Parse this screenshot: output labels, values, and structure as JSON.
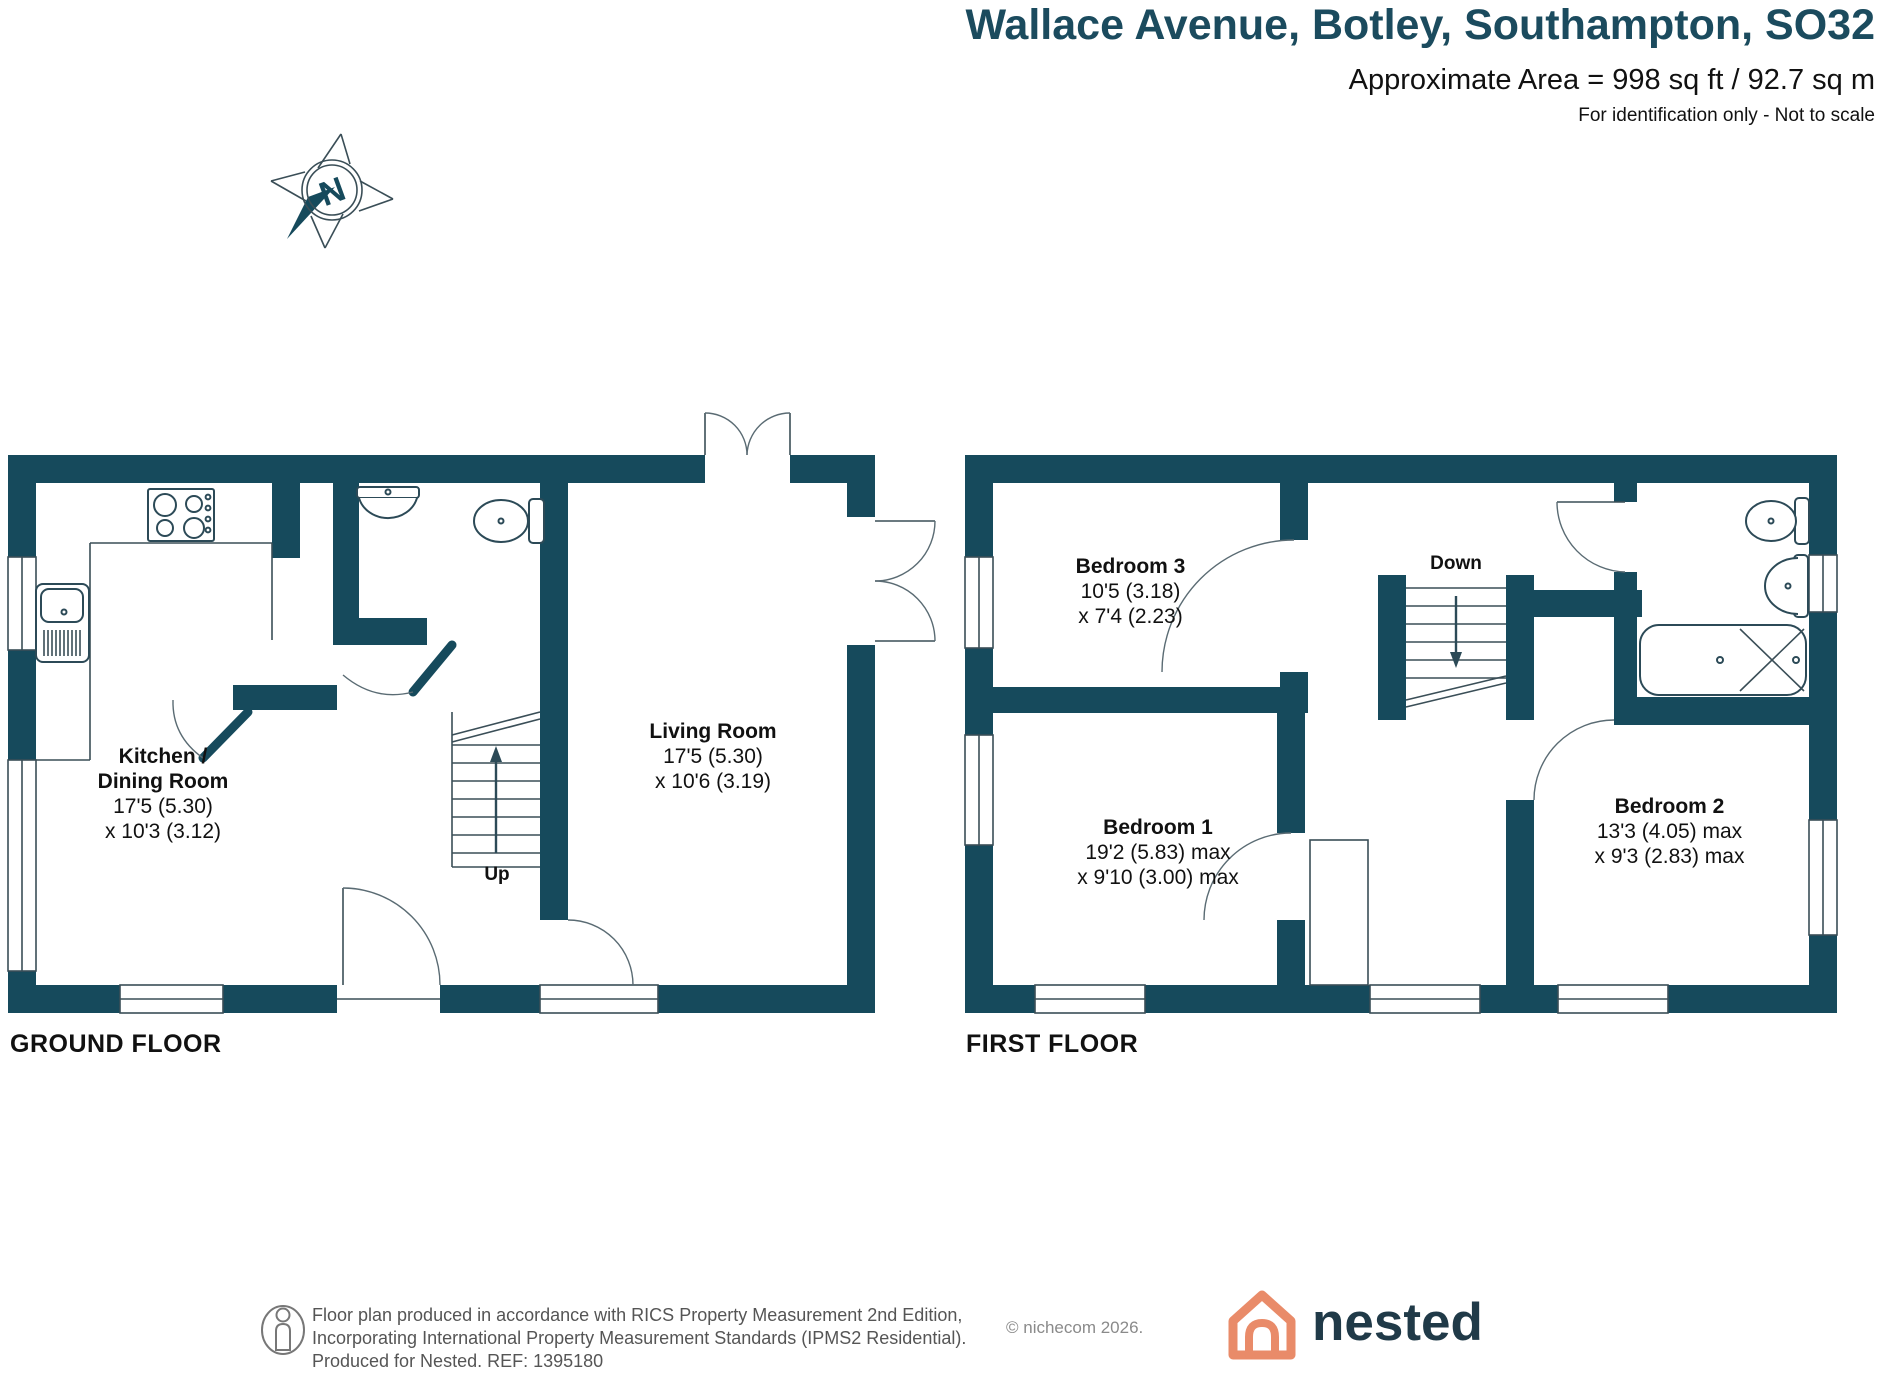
{
  "header": {
    "title": "Wallace Avenue, Botley, Southampton, SO32",
    "area_line": "Approximate Area = 998 sq ft / 92.7 sq m",
    "disclaimer": "For identification only - Not to scale"
  },
  "compass": {
    "label": "N"
  },
  "ground_floor": {
    "label": "GROUND FLOOR",
    "stairs_label": "Up",
    "rooms": {
      "kitchen_dining": {
        "lines": [
          "Kitchen /",
          "Dining Room",
          "17'5 (5.30)",
          "x 10'3 (3.12)"
        ]
      },
      "living_room": {
        "lines": [
          "Living Room",
          "17'5 (5.30)",
          "x 10'6 (3.19)"
        ]
      }
    }
  },
  "first_floor": {
    "label": "FIRST FLOOR",
    "stairs_label": "Down",
    "rooms": {
      "bedroom_3": {
        "lines": [
          "Bedroom 3",
          "10'5 (3.18)",
          "x 7'4 (2.23)"
        ]
      },
      "bedroom_1": {
        "lines": [
          "Bedroom 1",
          "19'2 (5.83) max",
          "x 9'10 (3.00) max"
        ]
      },
      "bedroom_2": {
        "lines": [
          "Bedroom 2",
          "13'3 (4.05) max",
          "x 9'3 (2.83) max"
        ]
      }
    }
  },
  "footer": {
    "line1": "Floor plan produced in accordance with RICS Property Measurement 2nd Edition,",
    "line2": "Incorporating International Property Measurement Standards (IPMS2 Residential).",
    "line3": "Produced for Nested.  REF:  1395180",
    "copyright": "© nichecom 2026.",
    "brand": "nested"
  },
  "colors": {
    "wall_teal": "#164A5C",
    "title_teal": "#1B4B5E",
    "brand_orange": "#E98B69",
    "brand_navy": "#203A48"
  }
}
